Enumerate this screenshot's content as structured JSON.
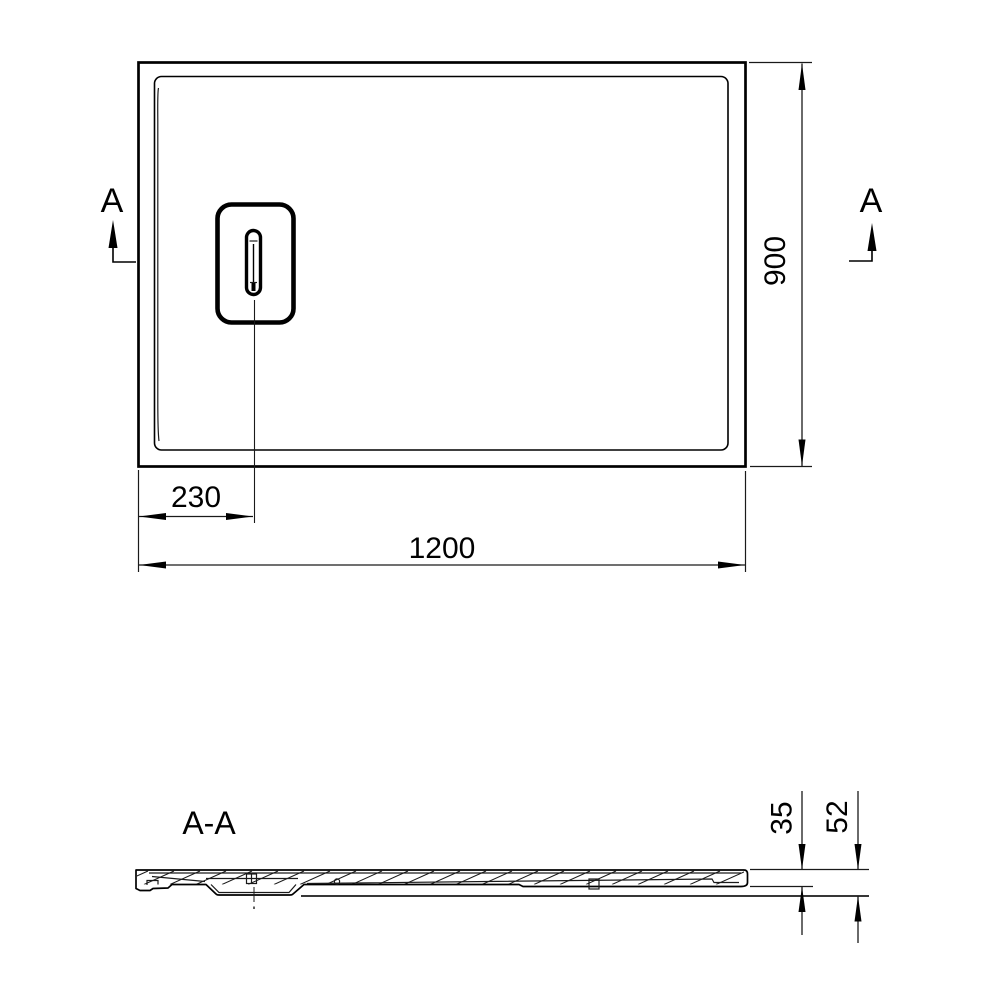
{
  "drawing": {
    "background_color": "#ffffff",
    "line_color": "#000000",
    "top_view": {
      "section_marker_left": "A",
      "section_marker_right": "A",
      "dim_width_mm": "1200",
      "dim_depth_mm": "900",
      "dim_drain_offset_mm": "230"
    },
    "section_view": {
      "title": "A-A",
      "dim_rim_height_mm": "35",
      "dim_total_height_mm": "52"
    }
  }
}
